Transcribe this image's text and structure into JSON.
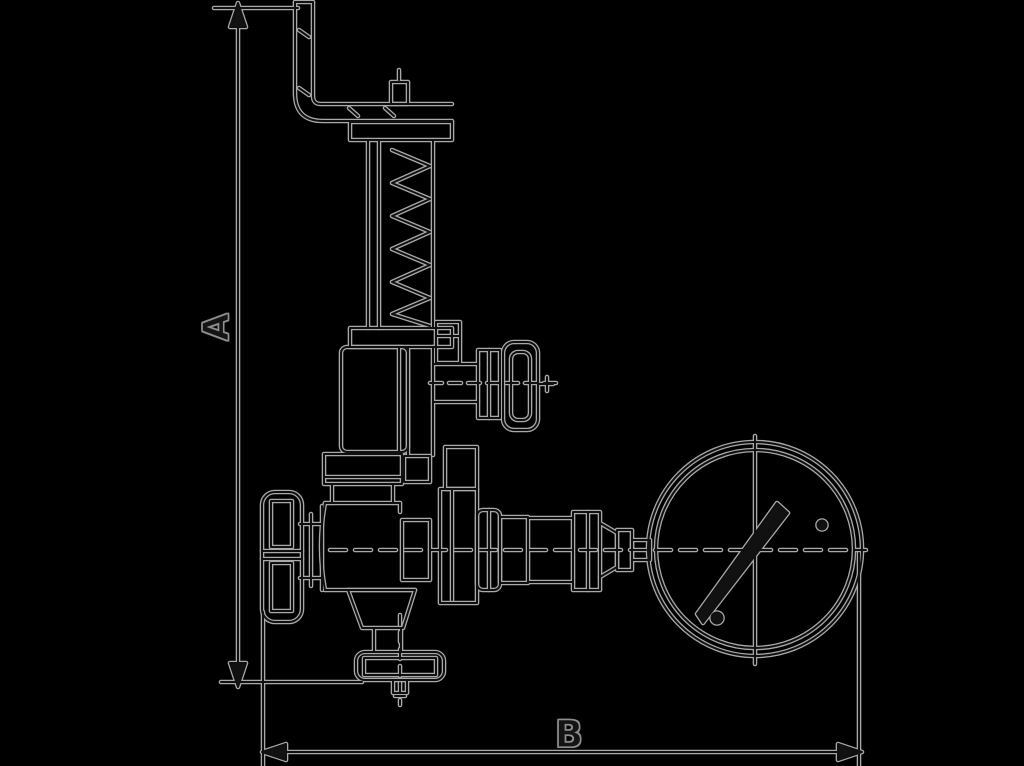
{
  "figure": {
    "background": "#000000",
    "halo_color": "#a8a8a8",
    "core_color": "#101010",
    "solid_fill": "#111111"
  },
  "dimension_labels": {
    "vertical": "A",
    "horizontal": "B"
  }
}
